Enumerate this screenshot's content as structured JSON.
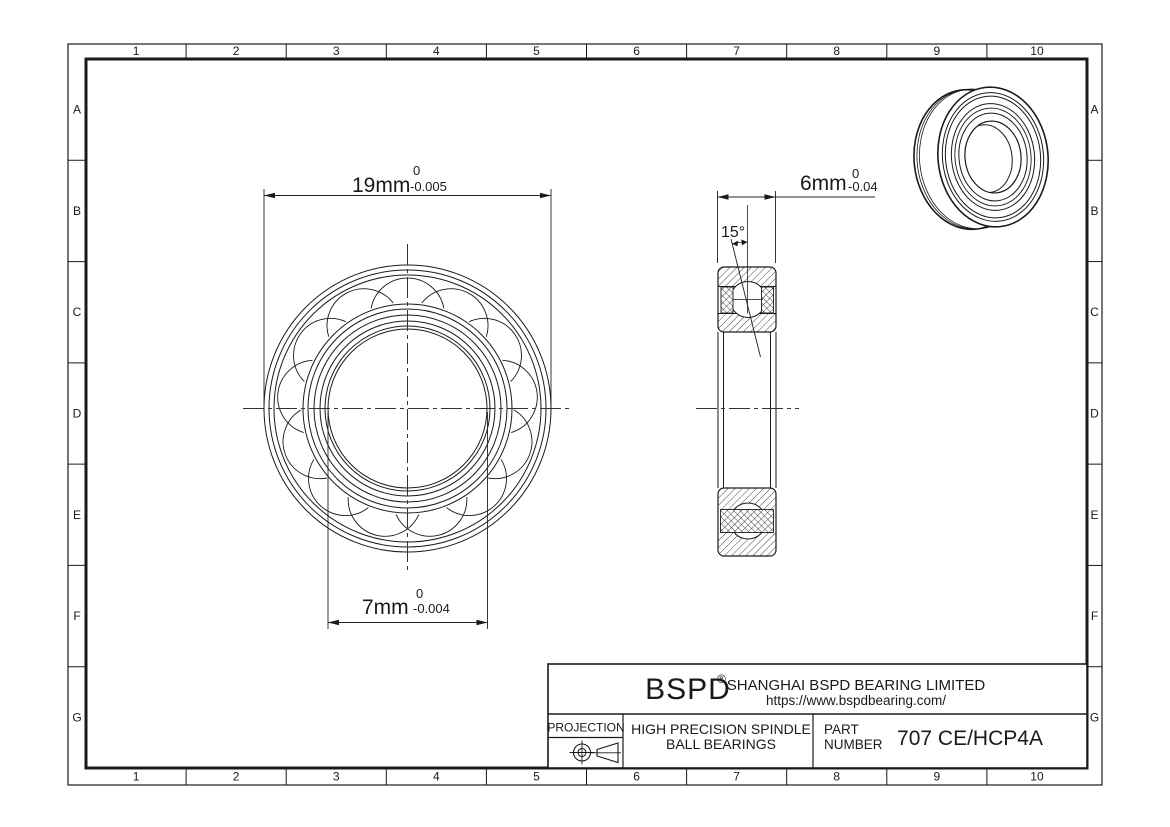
{
  "page": {
    "background": "#ffffff",
    "line_color": "#1a1a1a"
  },
  "grid": {
    "columns": [
      "1",
      "2",
      "3",
      "4",
      "5",
      "6",
      "7",
      "8",
      "9",
      "10"
    ],
    "rows": [
      "A",
      "B",
      "C",
      "D",
      "E",
      "F",
      "G"
    ]
  },
  "front_view": {
    "od_dim": {
      "value": "19mm",
      "tol_top": "0",
      "tol_bottom": "-0.005"
    },
    "bore_dim": {
      "value": "7mm",
      "tol_top": "0",
      "tol_bottom": "-0.004"
    }
  },
  "section_view": {
    "width_dim": {
      "value": "6mm",
      "tol_top": "0",
      "tol_bottom": "-0.04"
    },
    "angle_label": "15°"
  },
  "title_block": {
    "brand": "BSPD",
    "registered_mark": "®",
    "company": "SHANGHAI BSPD BEARING LIMITED",
    "website": "https://www.bspdbearing.com/",
    "projection_label": "PROJECTION",
    "product_line1": "HIGH  PRECISION SPINDLE",
    "product_line2": "BALL BEARINGS",
    "part_label_line1": "PART",
    "part_label_line2": "NUMBER",
    "part_number": "707 CE/HCP4A"
  }
}
